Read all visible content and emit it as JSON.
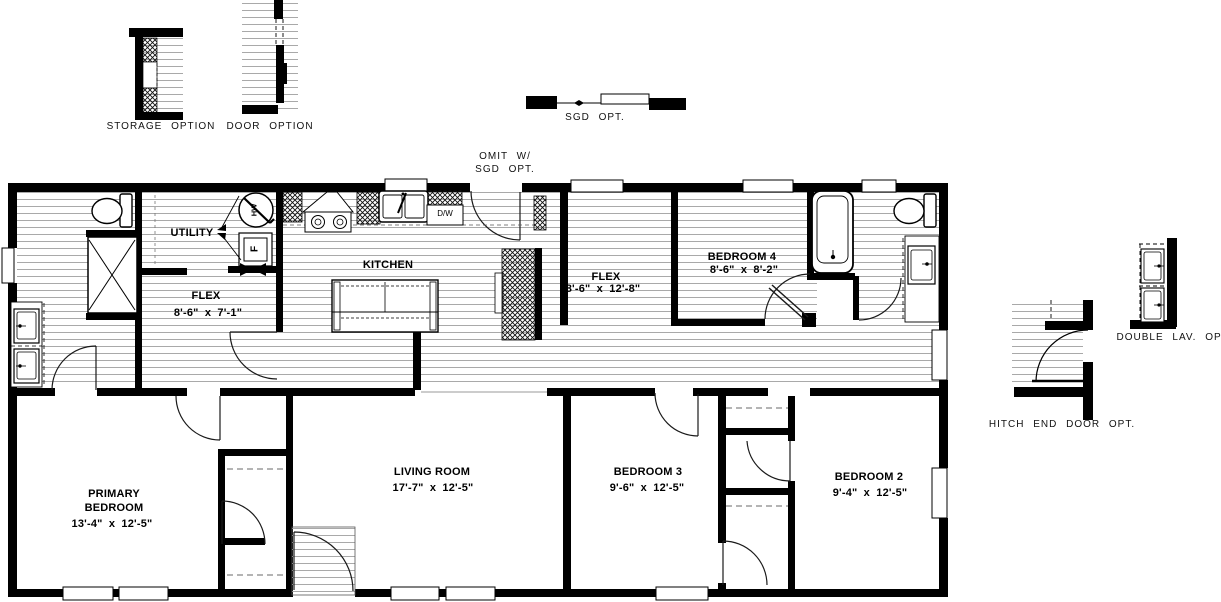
{
  "plan": {
    "rooms": {
      "utility": {
        "name": "UTILITY"
      },
      "flex_a": {
        "name": "FLEX",
        "dims": "8'-6\" x 7'-1\""
      },
      "kitchen": {
        "name": "KITCHEN"
      },
      "flex_b": {
        "name": "FLEX",
        "dims": "8'-6\" x 12'-8\""
      },
      "bedroom4": {
        "name": "BEDROOM 4",
        "dims": "8'-6\" x 8'-2\""
      },
      "primary_bedroom": {
        "name": "PRIMARY BEDROOM",
        "dims": "13'-4\" x 12'-5\""
      },
      "living_room": {
        "name": "LIVING ROOM",
        "dims": "17'-7\" x 12'-5\""
      },
      "bedroom3": {
        "name": "BEDROOM 3",
        "dims": "9'-6\" x 12'-5\""
      },
      "bedroom2": {
        "name": "BEDROOM 2",
        "dims": "9'-4\" x 12'-5\""
      }
    },
    "appliances": {
      "dishwasher": "D/W",
      "water_heater": "HW",
      "furnace": "F"
    }
  },
  "options": {
    "storage": "STORAGE OPTION",
    "door": "DOOR OPTION",
    "sgd": "SGD OPT.",
    "omit_with_sgd": "OMIT W/\nSGD OPT.",
    "hitch_end_door": "HITCH END DOOR OPT.",
    "double_lav": "DOUBLE LAV. OPT."
  },
  "colors": {
    "wall": "#000000",
    "floor_line": "#a9a9a9",
    "background": "#ffffff"
  }
}
